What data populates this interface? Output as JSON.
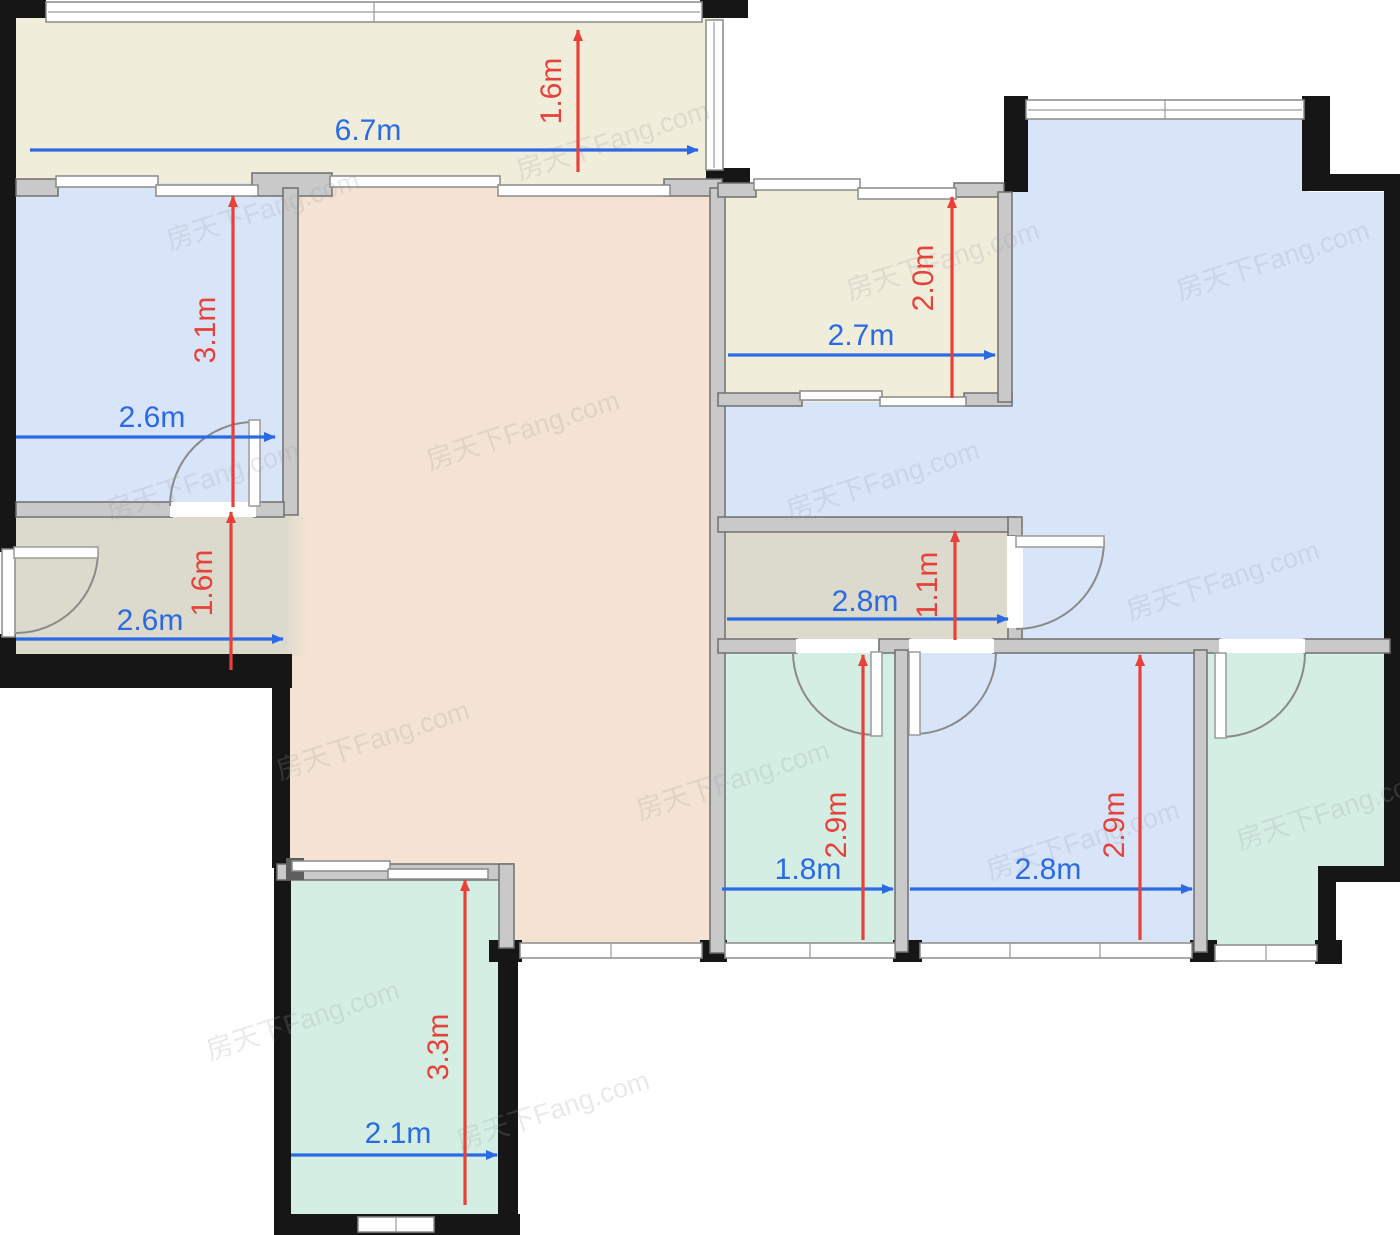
{
  "watermark": "房天下Fang.com",
  "colors": {
    "balcony": "#f0eddb",
    "bedroom": "#d8e5f8",
    "living": "#f4e2d2",
    "hall": "#dbdacd",
    "bath": "#d5eee3",
    "wall": "#161616",
    "dim_blue": "#2a6ae4",
    "dim_red": "#e8413a"
  },
  "dims": {
    "balcony_top_w": "6.7m",
    "balcony_top_h": "1.6m",
    "bedroom_left_w": "2.6m",
    "bedroom_left_h": "3.1m",
    "room_mid_w": "2.7m",
    "room_mid_h": "2.0m",
    "entry_hall_w": "2.6m",
    "entry_hall_h": "1.6m",
    "hall_mid_w": "2.8m",
    "hall_mid_h": "1.1m",
    "bath_w": "1.8m",
    "bath_h": "2.9m",
    "bedroom_br_w": "2.8m",
    "bedroom_br_h": "2.9m",
    "room_bl_w": "2.1m",
    "room_bl_h": "3.3m"
  }
}
